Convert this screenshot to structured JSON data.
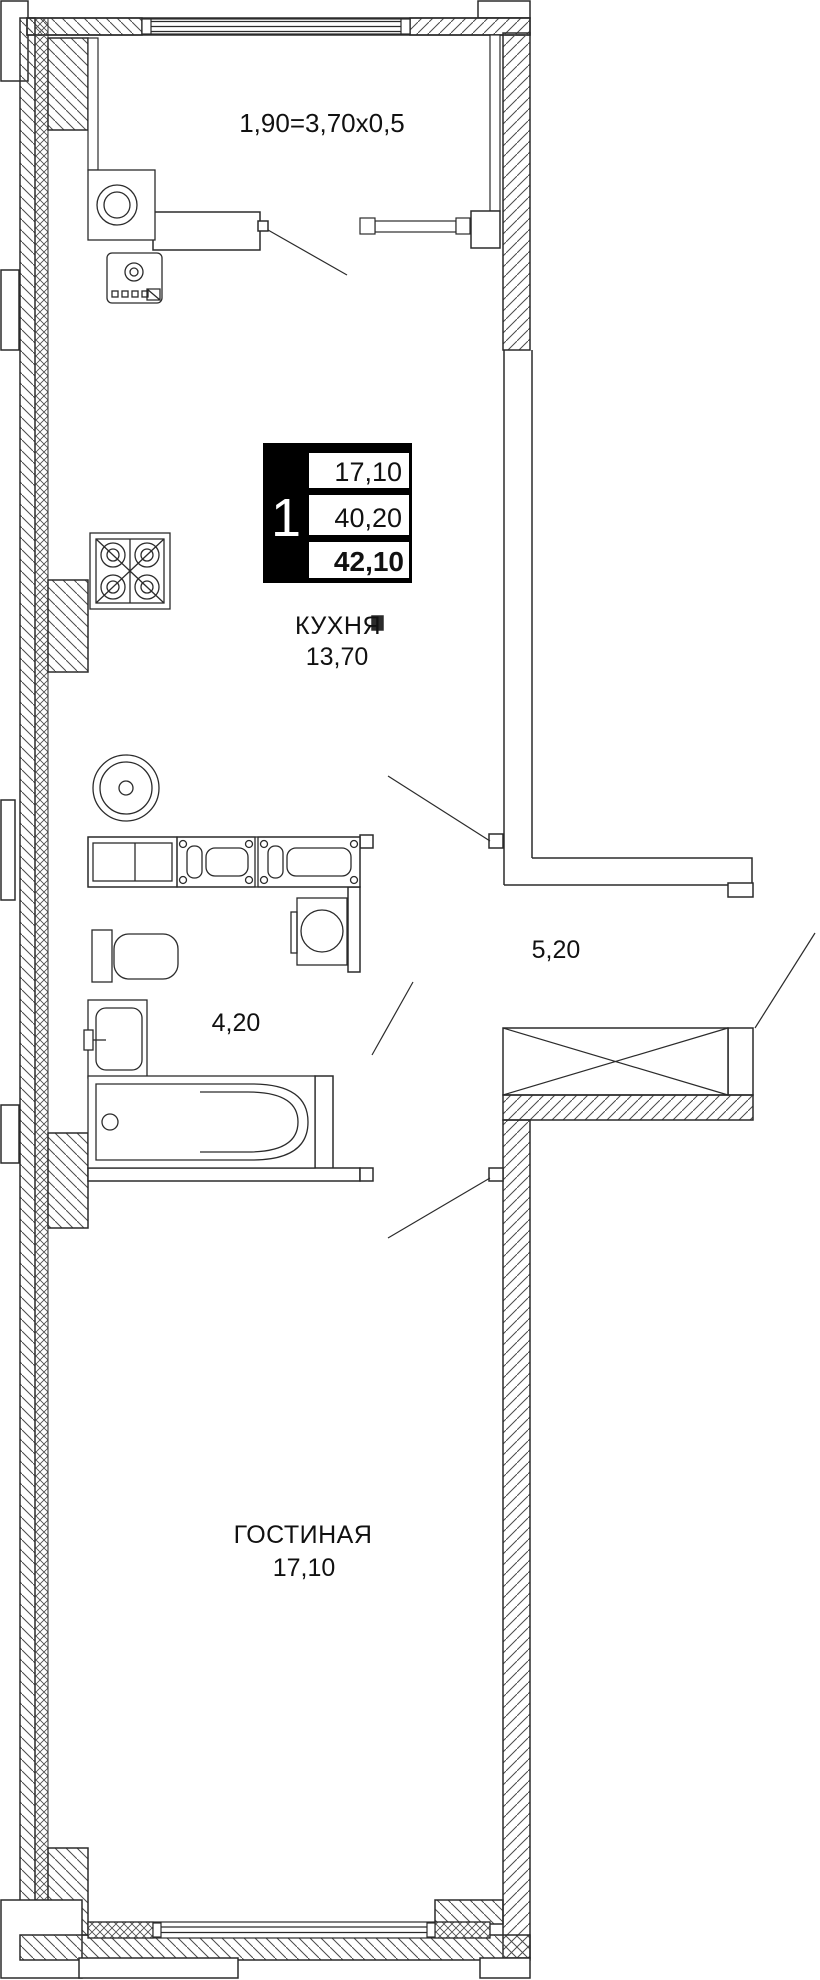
{
  "plan": {
    "balcony": {
      "formula": "1,90=3,70x0,5"
    },
    "info_box": {
      "unit_number": "1",
      "living_area": "17,10",
      "area_no_balcony": "40,20",
      "total_area": "42,10"
    },
    "kitchen": {
      "name": "КУХНЯ",
      "area": "13,70"
    },
    "hallway": {
      "area": "5,20"
    },
    "bathroom": {
      "area": "4,20"
    },
    "living_room": {
      "name": "ГОСТИНАЯ",
      "area": "17,10"
    },
    "colors": {
      "line": "#2b2b2b",
      "hatch": "#4a4a4a",
      "info_box_bg": "#000000",
      "background": "#ffffff"
    }
  }
}
